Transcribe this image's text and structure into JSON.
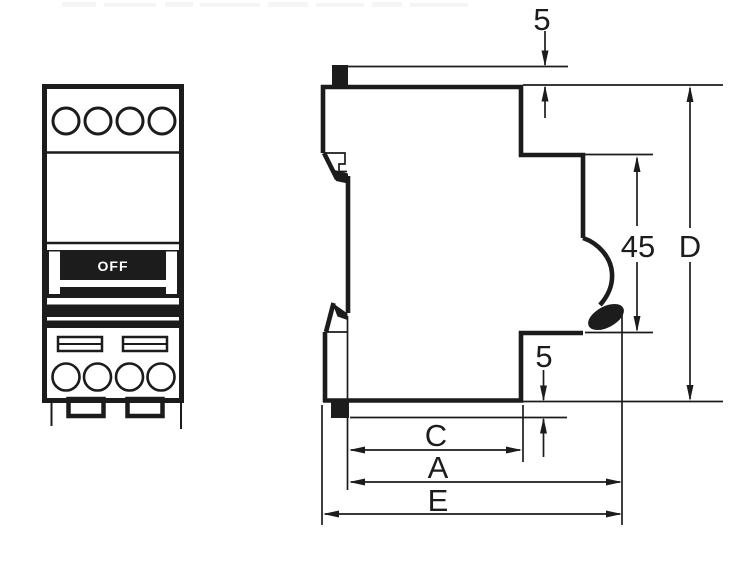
{
  "drawing": {
    "front_view": {
      "switch_state_label": "OFF"
    },
    "dimensions": {
      "top_clip_offset": "5",
      "bottom_clip_offset": "5",
      "front_recess_height": "45",
      "overall_height": "D",
      "depth_to_recess": "C",
      "depth_to_toggle": "A",
      "overall_depth": "E"
    },
    "colors": {
      "ink": "#1c1c1c",
      "paper": "#ffffff"
    }
  }
}
